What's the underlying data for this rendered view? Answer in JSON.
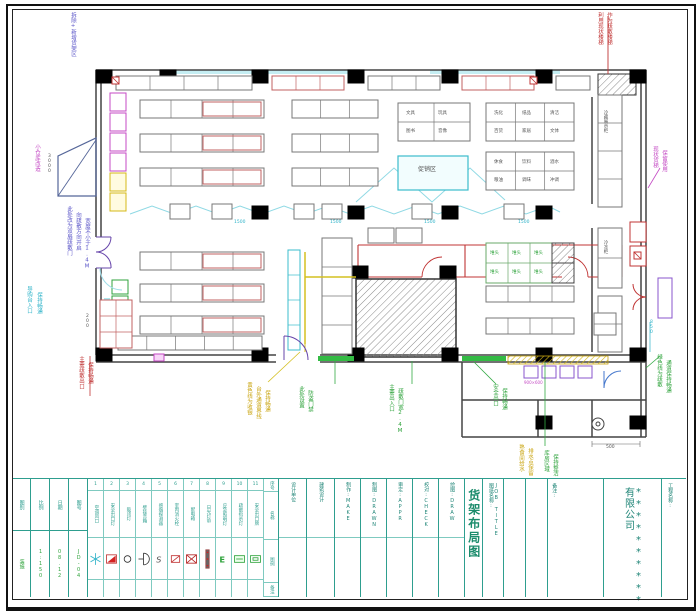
{
  "titleblock": {
    "info_columns": [
      {
        "label": "图别",
        "value": "装施"
      },
      {
        "label": "比例",
        "value": "1:150"
      },
      {
        "label": "日期",
        "value": "08.12"
      },
      {
        "label": "图号",
        "value": "JD-04"
      }
    ],
    "staff_columns": [
      {
        "label": "设计单位"
      },
      {
        "label": "建筑设计"
      },
      {
        "label": "制作:MAKE"
      },
      {
        "label": "制图:DRAWN"
      },
      {
        "label": "审定:APPR"
      },
      {
        "label": "校对:CHECK"
      },
      {
        "label": "绘图:DRAW"
      }
    ],
    "job_title_label": "图纸名称:",
    "job_title_label_en": "JOB TITLE",
    "drawing_title": "货架布局图",
    "remark_label": "备注:",
    "project_label": "工程名称:",
    "company": "**********有限公司"
  },
  "legend": {
    "row_labels": [
      "序号",
      "名称",
      "图例",
      "备注"
    ],
    "items": [
      {
        "no": "1",
        "name": "空调风口",
        "icon": "snowflake-icon"
      },
      {
        "no": "2",
        "name": "安全出口灯",
        "icon": "exit-light-icon"
      },
      {
        "no": "3",
        "name": "吸顶灯",
        "icon": "ceiling-lamp-icon"
      },
      {
        "no": "4",
        "name": "壁挂音箱",
        "icon": "speaker-icon"
      },
      {
        "no": "5",
        "name": "感烟探测器",
        "icon": "smoke-detector-icon"
      },
      {
        "no": "6",
        "name": "室内消火栓",
        "icon": "hydrant-icon"
      },
      {
        "no": "7",
        "name": "配电箱",
        "icon": "power-box-icon"
      },
      {
        "no": "8",
        "name": "日光灯带",
        "icon": "light-bar-icon"
      },
      {
        "no": "9",
        "name": "应急照明灯",
        "icon": "emergency-light-icon"
      },
      {
        "no": "10",
        "name": "疏散指示灯",
        "icon": "evac-sign-icon"
      },
      {
        "no": "11",
        "name": "安全出口牌",
        "icon": "exit-sign-icon"
      }
    ]
  },
  "annotations": [
    {
      "t": "拆除+新增货架区",
      "x": 70,
      "y": 12,
      "c": "blue",
      "v": 1
    },
    {
      "t": "小仓库改造",
      "x": 34,
      "y": 144,
      "c": "magenta",
      "v": 1
    },
    {
      "t": "导购台入口",
      "x": 26,
      "y": 286,
      "c": "cyan",
      "v": 1
    },
    {
      "t": "保持畅通",
      "x": 36,
      "y": 292,
      "c": "cyan",
      "v": 1
    },
    {
      "t": "此处改为双扇疏散门",
      "x": 66,
      "y": 206,
      "c": "blue",
      "v": 1
    },
    {
      "t": "向疏散方向开启",
      "x": 75,
      "y": 212,
      "c": "blue",
      "v": 1
    },
    {
      "t": "宽度不小于1.4M",
      "x": 84,
      "y": 218,
      "c": "blue",
      "v": 1
    },
    {
      "t": "主要疏散出口",
      "x": 78,
      "y": 356,
      "c": "red",
      "v": 1
    },
    {
      "t": "保持畅通",
      "x": 87,
      "y": 362,
      "c": "red",
      "v": 1
    },
    {
      "t": "利用现状楼梯",
      "x": 597,
      "y": 12,
      "c": "red",
      "v": 1
    },
    {
      "t": "作为疏散楼梯",
      "x": 606,
      "y": 12,
      "c": "red",
      "v": 1
    },
    {
      "t": "现状货梯",
      "x": 652,
      "y": 146,
      "c": "magenta",
      "v": 1
    },
    {
      "t": "保留使用",
      "x": 661,
      "y": 150,
      "c": "magenta",
      "v": 1
    },
    {
      "t": "绿色线为疏散",
      "x": 656,
      "y": 354,
      "c": "green",
      "v": 1
    },
    {
      "t": "通道保持畅通",
      "x": 665,
      "y": 360,
      "c": "green",
      "v": 1
    },
    {
      "t": "黄色线为收银",
      "x": 246,
      "y": 382,
      "c": "yellow",
      "v": 1
    },
    {
      "t": "台外通道界线",
      "x": 255,
      "y": 386,
      "c": "yellow",
      "v": 1
    },
    {
      "t": "保持畅通",
      "x": 264,
      "y": 390,
      "c": "yellow",
      "v": 1
    },
    {
      "t": "此处设置",
      "x": 298,
      "y": 386,
      "c": "green",
      "v": 1
    },
    {
      "t": "防盗门禁",
      "x": 307,
      "y": 390,
      "c": "green",
      "v": 1
    },
    {
      "t": "主要出入口",
      "x": 388,
      "y": 384,
      "c": "green",
      "v": 1
    },
    {
      "t": "疏散门宽2.4M",
      "x": 397,
      "y": 388,
      "c": "green",
      "v": 1
    },
    {
      "t": "安全出口",
      "x": 492,
      "y": 384,
      "c": "green",
      "v": 1
    },
    {
      "t": "保持畅通",
      "x": 501,
      "y": 388,
      "c": "green",
      "v": 1
    },
    {
      "t": "熟食间给水",
      "x": 518,
      "y": 444,
      "c": "yellow",
      "v": 1
    },
    {
      "t": "排水点保留",
      "x": 527,
      "y": 448,
      "c": "yellow",
      "v": 1
    },
    {
      "t": "库房区域",
      "x": 543,
      "y": 450,
      "c": "green",
      "v": 1
    },
    {
      "t": "保持整洁",
      "x": 552,
      "y": 454,
      "c": "green",
      "v": 1
    },
    {
      "t": "促销区",
      "x": 418,
      "y": 167,
      "c": "dark",
      "fs": 6
    },
    {
      "t": "冷藏展示柜",
      "x": 602,
      "y": 110,
      "c": "dark",
      "v": 1,
      "fs": 4.5
    },
    {
      "t": "冷冻柜",
      "x": 602,
      "y": 240,
      "c": "dark",
      "v": 1,
      "fs": 4.5
    },
    {
      "t": "1500",
      "x": 234,
      "y": 221,
      "c": "cyan",
      "fs": 4.5
    },
    {
      "t": "1500",
      "x": 330,
      "y": 221,
      "c": "cyan",
      "fs": 4.5
    },
    {
      "t": "1500",
      "x": 424,
      "y": 221,
      "c": "cyan",
      "fs": 4.5
    },
    {
      "t": "1500",
      "x": 518,
      "y": 221,
      "c": "cyan",
      "fs": 4.5
    },
    {
      "t": "500",
      "x": 606,
      "y": 446,
      "c": "dark",
      "fs": 4.5
    },
    {
      "t": "850",
      "x": 648,
      "y": 320,
      "c": "cyan",
      "v": 1,
      "fs": 4.5
    },
    {
      "t": "200",
      "x": 84,
      "y": 314,
      "c": "dark",
      "v": 1,
      "fs": 4.5
    },
    {
      "t": "3000",
      "x": 46,
      "y": 154,
      "c": "dark",
      "v": 1,
      "fs": 4.5
    },
    {
      "t": "900×600",
      "x": 524,
      "y": 381,
      "c": "magenta",
      "fs": 4
    },
    {
      "t": "文具",
      "x": 406,
      "y": 112,
      "c": "dark",
      "fs": 4.5
    },
    {
      "t": "玩具",
      "x": 438,
      "y": 112,
      "c": "dark",
      "fs": 4.5
    },
    {
      "t": "图书",
      "x": 406,
      "y": 130,
      "c": "dark",
      "fs": 4.5
    },
    {
      "t": "音像",
      "x": 438,
      "y": 130,
      "c": "dark",
      "fs": 4.5
    },
    {
      "t": "洗化",
      "x": 494,
      "y": 112,
      "c": "dark",
      "fs": 4.5
    },
    {
      "t": "纸品",
      "x": 522,
      "y": 112,
      "c": "dark",
      "fs": 4.5
    },
    {
      "t": "清洁",
      "x": 550,
      "y": 112,
      "c": "dark",
      "fs": 4.5
    },
    {
      "t": "百货",
      "x": 494,
      "y": 130,
      "c": "dark",
      "fs": 4.5
    },
    {
      "t": "家居",
      "x": 522,
      "y": 130,
      "c": "dark",
      "fs": 4.5
    },
    {
      "t": "文体",
      "x": 550,
      "y": 130,
      "c": "dark",
      "fs": 4.5
    },
    {
      "t": "休食",
      "x": 494,
      "y": 161,
      "c": "dark",
      "fs": 4.5
    },
    {
      "t": "饮料",
      "x": 522,
      "y": 161,
      "c": "dark",
      "fs": 4.5
    },
    {
      "t": "酒水",
      "x": 550,
      "y": 161,
      "c": "dark",
      "fs": 4.5
    },
    {
      "t": "粮油",
      "x": 494,
      "y": 179,
      "c": "dark",
      "fs": 4.5
    },
    {
      "t": "调味",
      "x": 522,
      "y": 179,
      "c": "dark",
      "fs": 4.5
    },
    {
      "t": "冲调",
      "x": 550,
      "y": 179,
      "c": "dark",
      "fs": 4.5
    },
    {
      "t": "堆头",
      "x": 490,
      "y": 252,
      "c": "green",
      "fs": 4.5
    },
    {
      "t": "堆头",
      "x": 512,
      "y": 252,
      "c": "green",
      "fs": 4.5
    },
    {
      "t": "堆头",
      "x": 534,
      "y": 252,
      "c": "green",
      "fs": 4.5
    },
    {
      "t": "堆头",
      "x": 490,
      "y": 271,
      "c": "green",
      "fs": 4.5
    },
    {
      "t": "堆头",
      "x": 512,
      "y": 271,
      "c": "green",
      "fs": 4.5
    },
    {
      "t": "堆头",
      "x": 534,
      "y": 271,
      "c": "green",
      "fs": 4.5
    }
  ]
}
